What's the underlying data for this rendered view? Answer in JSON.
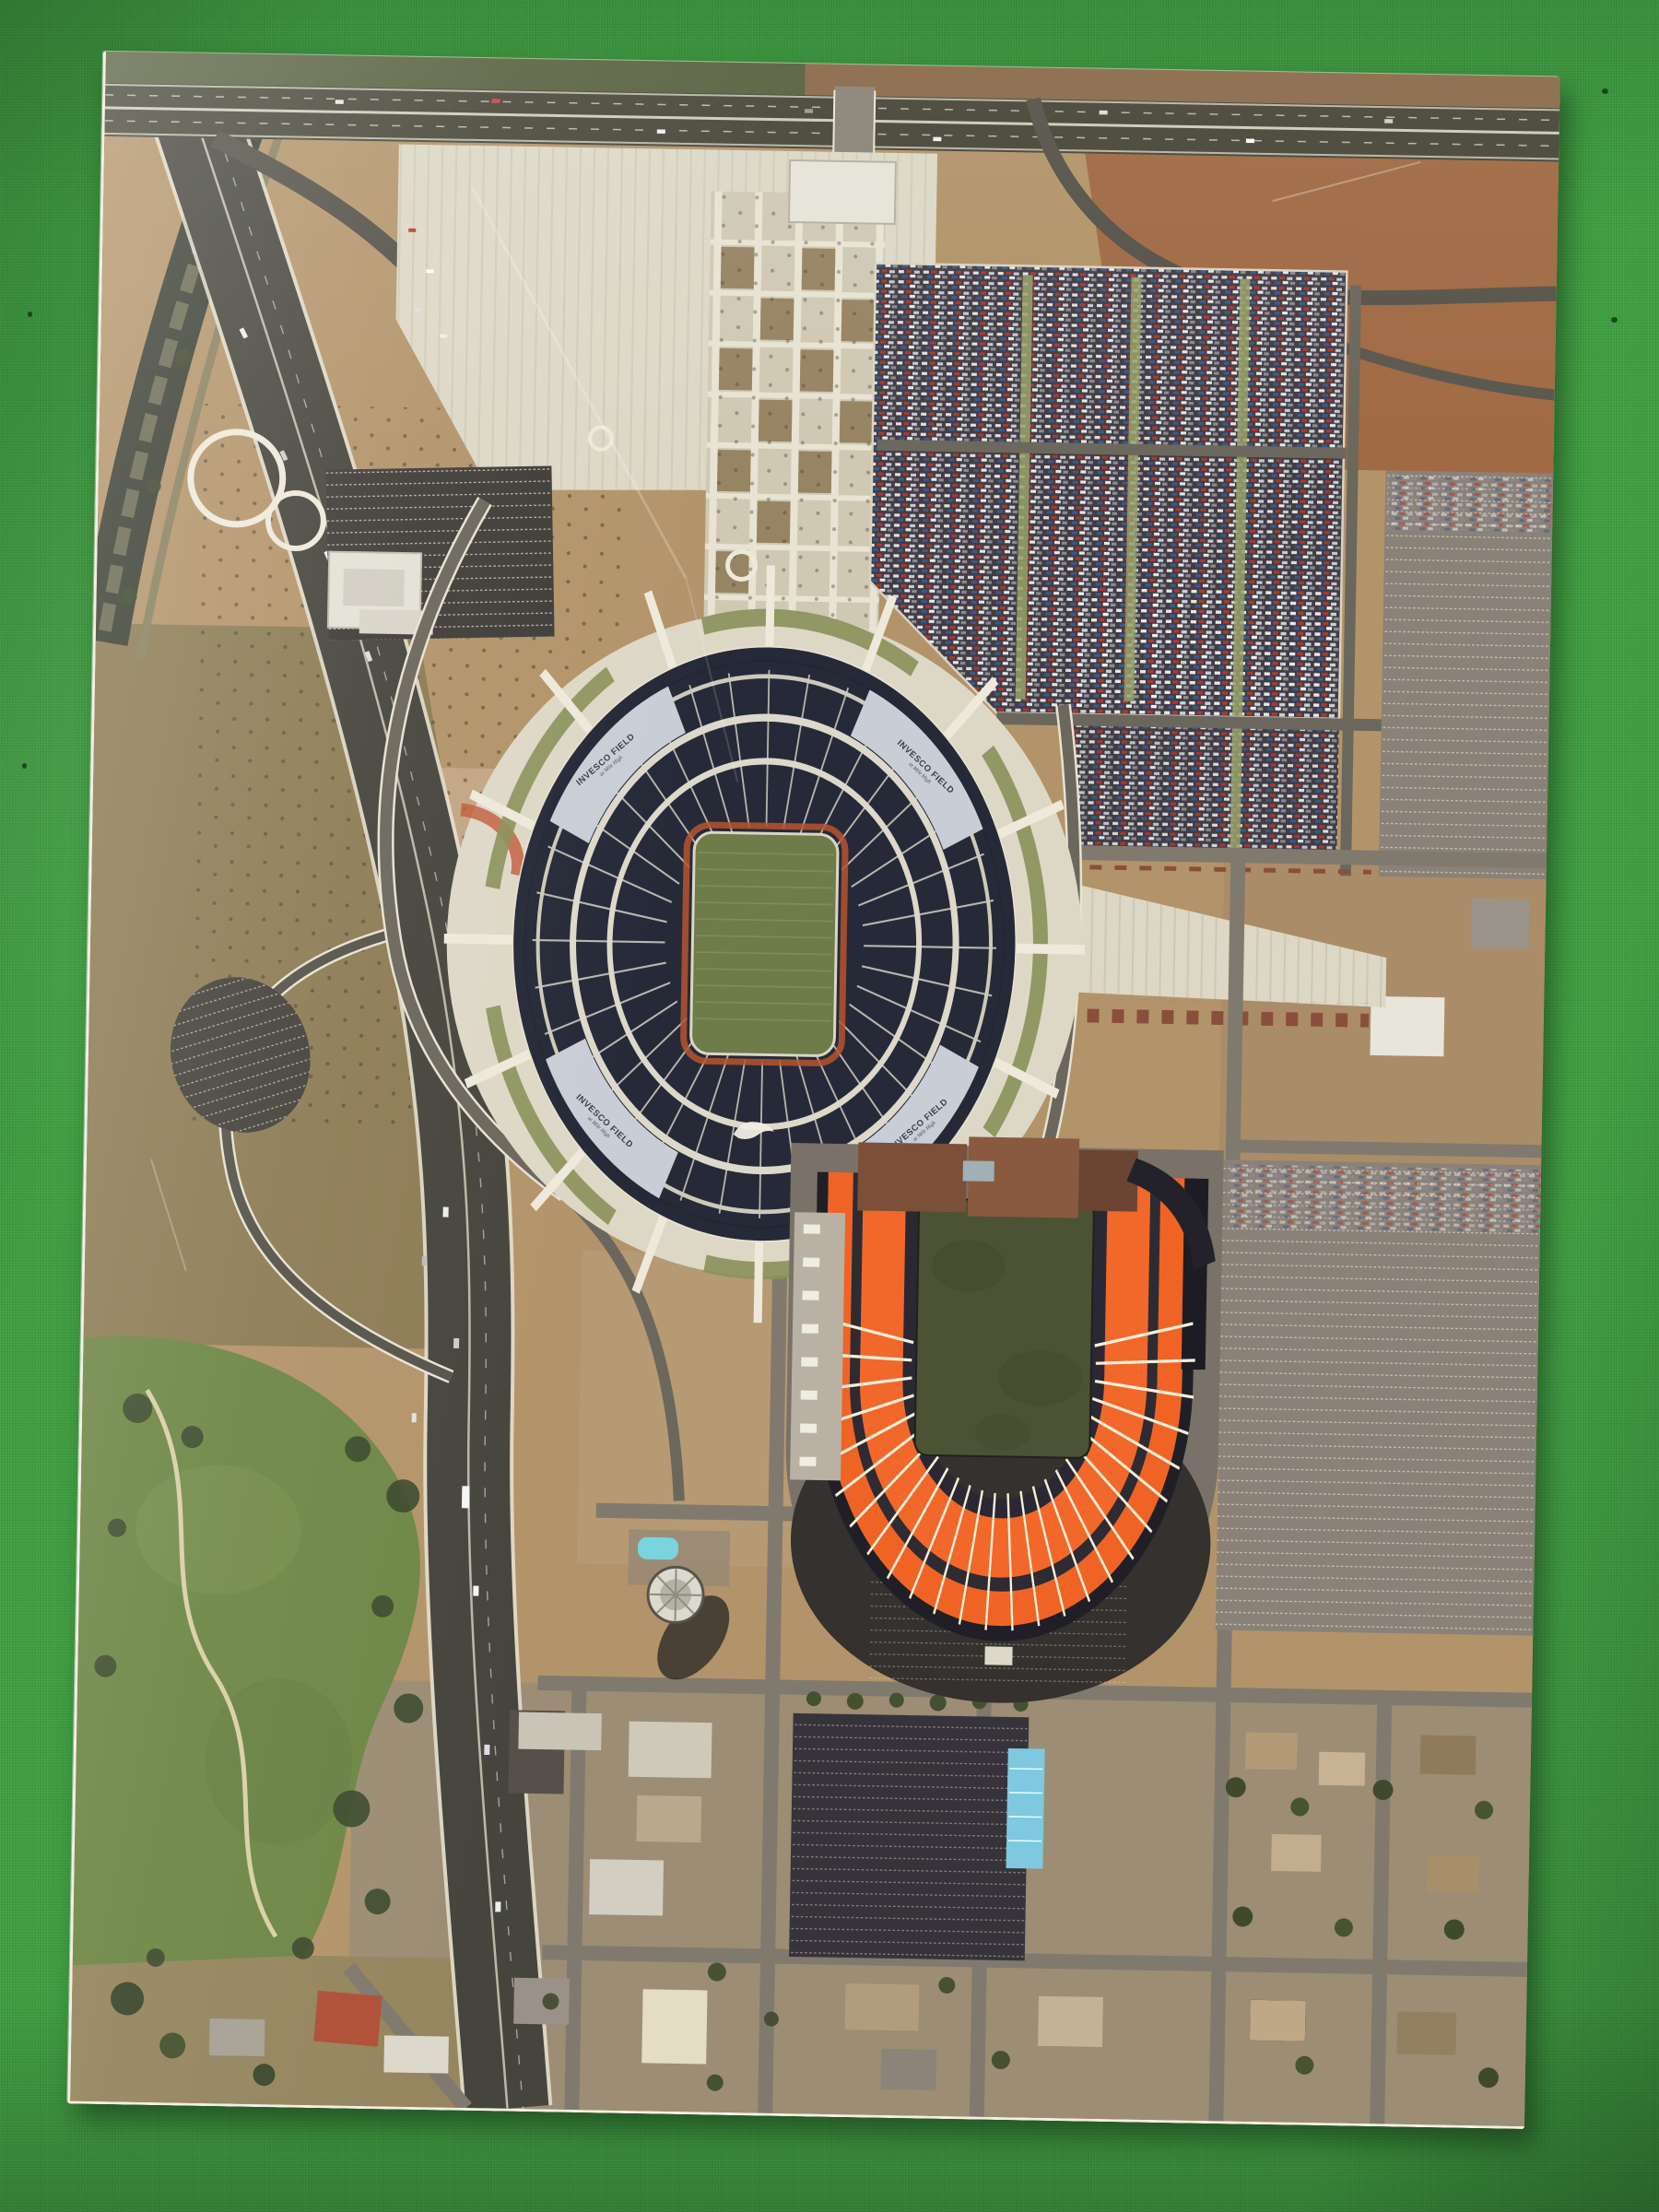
{
  "stadium_upper": {
    "roof_label": "INVESCO FIELD",
    "roof_label_sub": "at Mile High",
    "roof_label_count": 4,
    "logo": "broncos-horse-white",
    "bowl_color": "#262a38",
    "field_color": "#6d7c49"
  },
  "stadium_lower": {
    "shape": "horseshoe-open-north",
    "seat_color": "#f2682a",
    "field_color": "#4b5334"
  },
  "colors": {
    "fabric": "#3f9e41",
    "fabric_dark": "#2b7c31",
    "paper": "#f2efe3",
    "dirt": "#b3946a",
    "dirt_red": "#a06a44",
    "dirt_pink": "#c2a584",
    "scrub": "#8d7c55",
    "tan_dark": "#95865f",
    "concrete": "#ddd8c6",
    "concrete_dim": "#cfc9b4",
    "asphalt": "#46453d",
    "road_gray": "#7b766b",
    "lot_dark": "#423c44",
    "lot_gray": "#8a8178",
    "navy": "#262a38",
    "navy_rim": "#1b1f2e",
    "roof_gray": "#c9ced6",
    "field_upper": "#6d7c49",
    "field_lower": "#4b5334",
    "track": "#b6542f",
    "orange": "#f2682a",
    "orange_deep": "#e05a1f",
    "white_line": "#e9e5d6",
    "green_median": "#8a9159",
    "golf": "#6e8746",
    "tree": "#3c4a2e",
    "pool": "#7ad4e0",
    "blue_roof": "#7ec8e0",
    "brick": "#8a4f3c",
    "brown_roof": "#7c4f38"
  }
}
